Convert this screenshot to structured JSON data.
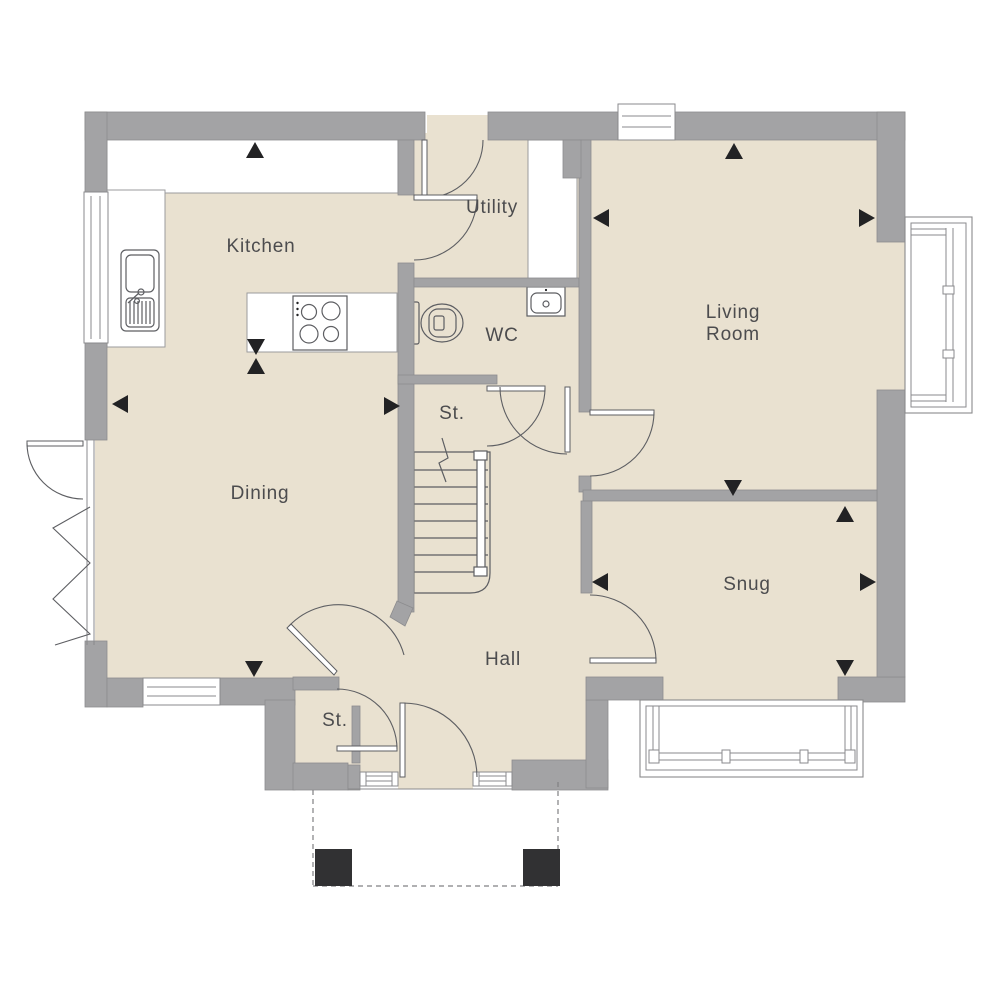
{
  "plan": {
    "type": "ground-floor-plan",
    "background": "#ffffff"
  },
  "colors": {
    "wall": "#a3a3a5",
    "wall-edge": "#8c8c8e",
    "floor": "#e9e1d0",
    "line": "#5d5e62",
    "frame": "#8a8a8c",
    "label": "#4c4c4e",
    "marker": "#222224",
    "post": "#313133",
    "white": "#ffffff"
  },
  "rooms": {
    "kitchen": {
      "label": "Kitchen"
    },
    "utility": {
      "label": "Utility"
    },
    "living_room": {
      "label_line1": "Living",
      "label_line2": "Room"
    },
    "wc": {
      "label": "WC"
    },
    "stair_store": {
      "label": "St."
    },
    "dining": {
      "label": "Dining"
    },
    "hall": {
      "label": "Hall"
    },
    "snug": {
      "label": "Snug"
    },
    "entrance_store": {
      "label": "St."
    }
  },
  "fixtures": [
    "kitchen-sink",
    "hob",
    "kitchen-island",
    "worktop",
    "toilet",
    "basin",
    "staircase",
    "bay-window",
    "porch-posts"
  ],
  "markers": [
    {
      "name": "kitchen-top",
      "x": 255,
      "y": 150,
      "dir": "up"
    },
    {
      "name": "island-down",
      "x": 256,
      "y": 347,
      "dir": "down"
    },
    {
      "name": "island-up",
      "x": 256,
      "y": 366,
      "dir": "up"
    },
    {
      "name": "dining-left",
      "x": 120,
      "y": 404,
      "dir": "left"
    },
    {
      "name": "dining-right",
      "x": 392,
      "y": 406,
      "dir": "right"
    },
    {
      "name": "dining-bottom",
      "x": 254,
      "y": 669,
      "dir": "down"
    },
    {
      "name": "living-top",
      "x": 734,
      "y": 151,
      "dir": "up"
    },
    {
      "name": "living-left",
      "x": 601,
      "y": 218,
      "dir": "left"
    },
    {
      "name": "living-right",
      "x": 867,
      "y": 218,
      "dir": "right"
    },
    {
      "name": "living-bottom",
      "x": 733,
      "y": 488,
      "dir": "down"
    },
    {
      "name": "snug-top",
      "x": 845,
      "y": 514,
      "dir": "up"
    },
    {
      "name": "snug-left",
      "x": 600,
      "y": 582,
      "dir": "left"
    },
    {
      "name": "snug-right",
      "x": 868,
      "y": 582,
      "dir": "right"
    },
    {
      "name": "snug-bottom",
      "x": 845,
      "y": 668,
      "dir": "down"
    }
  ]
}
